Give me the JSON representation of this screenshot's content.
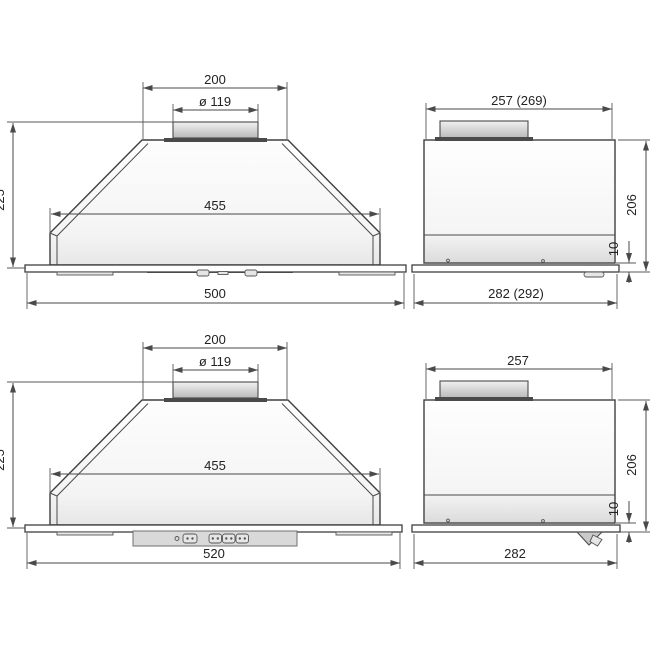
{
  "views": {
    "front_top": {
      "top_width": "200",
      "duct_diameter": "ø 119",
      "inner_width": "455",
      "height": "225",
      "overall_width": "500"
    },
    "side_top": {
      "depth_top": "257 (269)",
      "body_height": "206",
      "bottom_gap": "10",
      "depth_overall": "282 (292)"
    },
    "front_bottom": {
      "top_width": "200",
      "duct_diameter": "ø 119",
      "inner_width": "455",
      "height": "225",
      "overall_width": "520"
    },
    "side_bottom": {
      "depth_top": "257",
      "body_height": "206",
      "bottom_gap": "10",
      "depth_overall": "282"
    }
  }
}
